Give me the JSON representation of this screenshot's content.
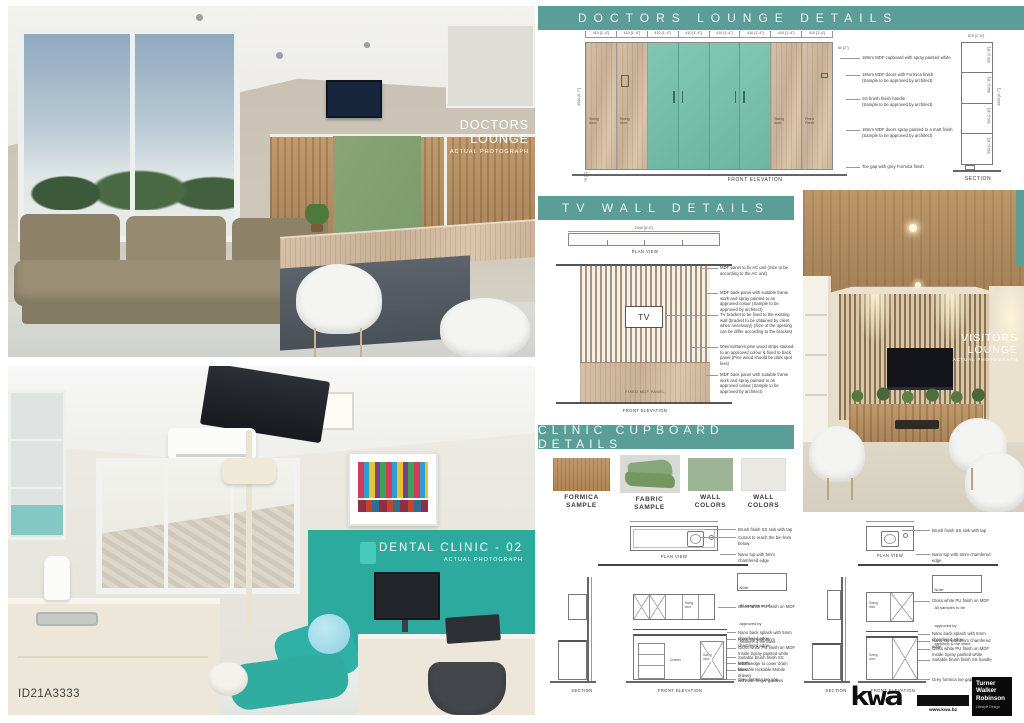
{
  "colors": {
    "header_teal": "#5b9d97",
    "door_green": "#74c0a8",
    "sage_green": "#9db594",
    "off_white": "#eae8e2",
    "formica_wood": "#b98f63",
    "fabric_green": "#85a87b",
    "dental_teal": "#2baa9d"
  },
  "photos": {
    "doctors_lounge": {
      "title_line1": "DOCTORS",
      "title_line2": "LOUNGE",
      "subtitle": "ACTUAL PHOTOGRAPH"
    },
    "dental_clinic": {
      "title": "DENTAL CLINIC - 02",
      "subtitle": "ACTUAL PHOTOGRAPH",
      "id_label": "ID21A3333"
    },
    "visitors_lounge": {
      "title_line1": "VISITORS",
      "title_line2": "LOUNGE",
      "subtitle": "ACTUAL PHOTOGRAPH"
    }
  },
  "doctors_details": {
    "title": "DOCTORS LOUNGE DETAILS",
    "top_dims": [
      "410 [1'-4\"]",
      "410 [1'-4\"]",
      "410 [1'-4\"]",
      "410 [1'-4\"]",
      "410 [1'-4\"]",
      "410 [1'-4\"]",
      "410 [1'-4\"]",
      "410 [1'-4\"]"
    ],
    "gap_dim": "50 [2\"]",
    "height_dim": "2000 [6'-7\"]",
    "toe_dim": "75 [3\"]",
    "door_labels": {
      "swing": "Swing\ndoor",
      "fixed": "Fixed\nPanel"
    },
    "annotations": [
      "18mm MDF cupboard with spray painted white",
      "18mm MDF doors with Formica finish\n(Sample to be approved by architect)",
      "SS brush finish handle\n(Sample to be approved by architect)",
      "18mm MDF doors spray painted to a matt finish\n(Sample to be approved by architect)",
      "Toe gap with grey Formica finish"
    ],
    "elevation_caption": "FRONT ELEVATION",
    "section_caption": "SECTION",
    "section_top_dim": "875 [1'-9\"]",
    "section_cell_dim": "500 [1'-8\"]",
    "section_height_dim": "2000 [6'-7\"]"
  },
  "tv_wall": {
    "title": "TV WALL DETAILS",
    "plan_dim": "2440 [8'-0\"]",
    "plan_caption": "PLAN VIEW",
    "tv_label": "TV",
    "panel_label": "FIXED MDF PANEL",
    "elevation_caption": "FRONT ELEVATION",
    "annotations": [
      "MDF panel to fix AC unit (Size to be according to the AC unit)",
      "MDF back panel with suitable frame work and spray painted to an approved colour (Sample to be approved by architect)",
      "TV bracket to be fixed to the existing wall (bracket to be obtained by client when necessary) (Size of the opening can be differ according to the bracket)",
      "50mmx25mm pine wood strips stained to an approved colour & fixed to back panel (Pine wood should be dark spot less)",
      "MDF back panel with suitable frame work and spray painted to an approved colour (Sample to be approved by architect)"
    ]
  },
  "clinic_cupboard": {
    "title": "CLINIC CUPBOARD DETAILS",
    "samples": [
      {
        "label": "FORMICA\nSAMPLE"
      },
      {
        "label": "FABRIC\nSAMPLE"
      },
      {
        "label": "WALL\nCOLORS"
      },
      {
        "label": "WALL\nCOLORS"
      }
    ],
    "captions": {
      "plan": "PLAN VIEW",
      "section": "SECTION",
      "front": "FRONT ELEVATION"
    },
    "note": "Note:\nAll samples to be approved by\narchitect & the client",
    "swing_door": "Swing\ndoor",
    "drawer_label": "Drawer",
    "left": {
      "plan_annotations": [
        "Brush finish SS sink with tap",
        "Cutout to reach the bin from below",
        "Nano top with 5mm chamfered edge"
      ],
      "upper_annotation": "Gloss white PU finish on MDF",
      "lower_annotations": [
        "Nano back splash with 5mm chamfered edge",
        "Nano top with 5mm chamfered edge",
        "Gloss white PU finish on MDF\nInside Spray painted white",
        "Suitable brush finish SS handle",
        "MEP Ledge to cover drain lines",
        "Movable lockable Mobile drawer\nwith side finger grooves",
        "Grey formica toe gap"
      ]
    },
    "right": {
      "plan_annotations": [
        "Brush finish SS sink with tap",
        "Nano top with 5mm chamfered edge"
      ],
      "upper_annotation": "Gloss white PU finish on MDF",
      "lower_annotations": [
        "Nano back splash with 5mm chamfered edge",
        "Nano top with 5mm chamfered edge",
        "Gloss white PU finish on MDF\nInside Spray painted white",
        "Suitable brush finish SS handle",
        "Grey formica toe gap"
      ]
    }
  },
  "footer": {
    "logo": "kwa",
    "website": "www.kwa.bz",
    "company_line1": "Turner",
    "company_line2": "Walker",
    "company_line3": "Robinson",
    "tagline": "Lifestyle Design"
  }
}
